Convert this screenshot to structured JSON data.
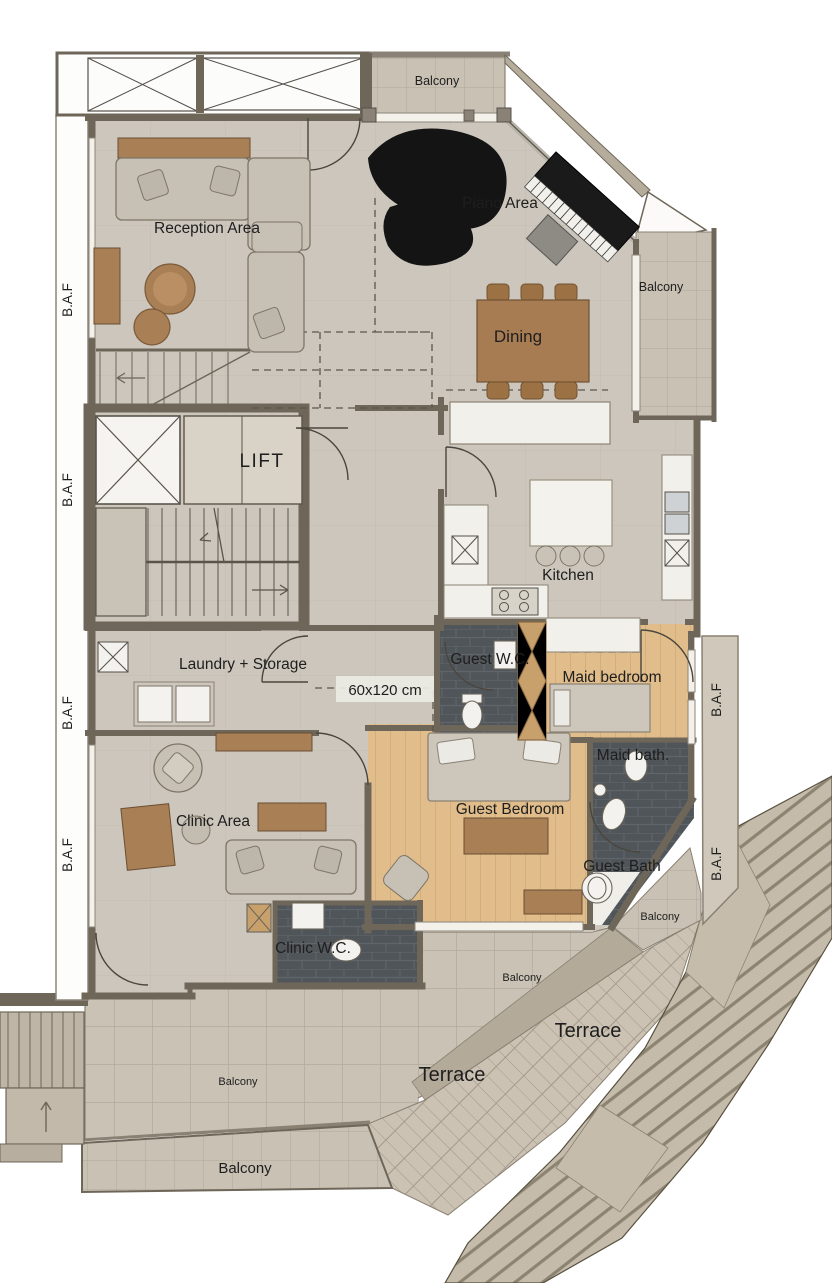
{
  "plan": {
    "type": "architectural-floor-plan",
    "labels": {
      "balcony": "Balcony",
      "terrace": "Terrace",
      "baf": "B.A.F",
      "reception_area": "Reception Area",
      "piano_area": "Piano Area",
      "dining": "Dining",
      "lift": "LIFT",
      "kitchen": "Kitchen",
      "laundry_storage": "Laundry + Storage",
      "guest_wc": "Guest W.C.",
      "maid_bedroom": "Maid bedroom",
      "dimension_note": "60x120 cm",
      "maid_bath": "Maid bath.",
      "clinic_area": "Clinic Area",
      "guest_bedroom": "Guest Bedroom",
      "guest_bath": "Guest Bath",
      "clinic_wc": "Clinic W.C."
    },
    "colors": {
      "wall": "#6e6759",
      "stone_floor": "#cdc6bc",
      "wood_floor": "#e0bd8b",
      "wood_furniture": "#a97f55",
      "dark_bath_tile": "#50555a",
      "balcony_tile": "#c8c1b4",
      "terrace": "#cbc2b3",
      "deck": "#c5bbaa",
      "piano_black": "#141414",
      "fixture_white": "#f4f2ee"
    }
  }
}
